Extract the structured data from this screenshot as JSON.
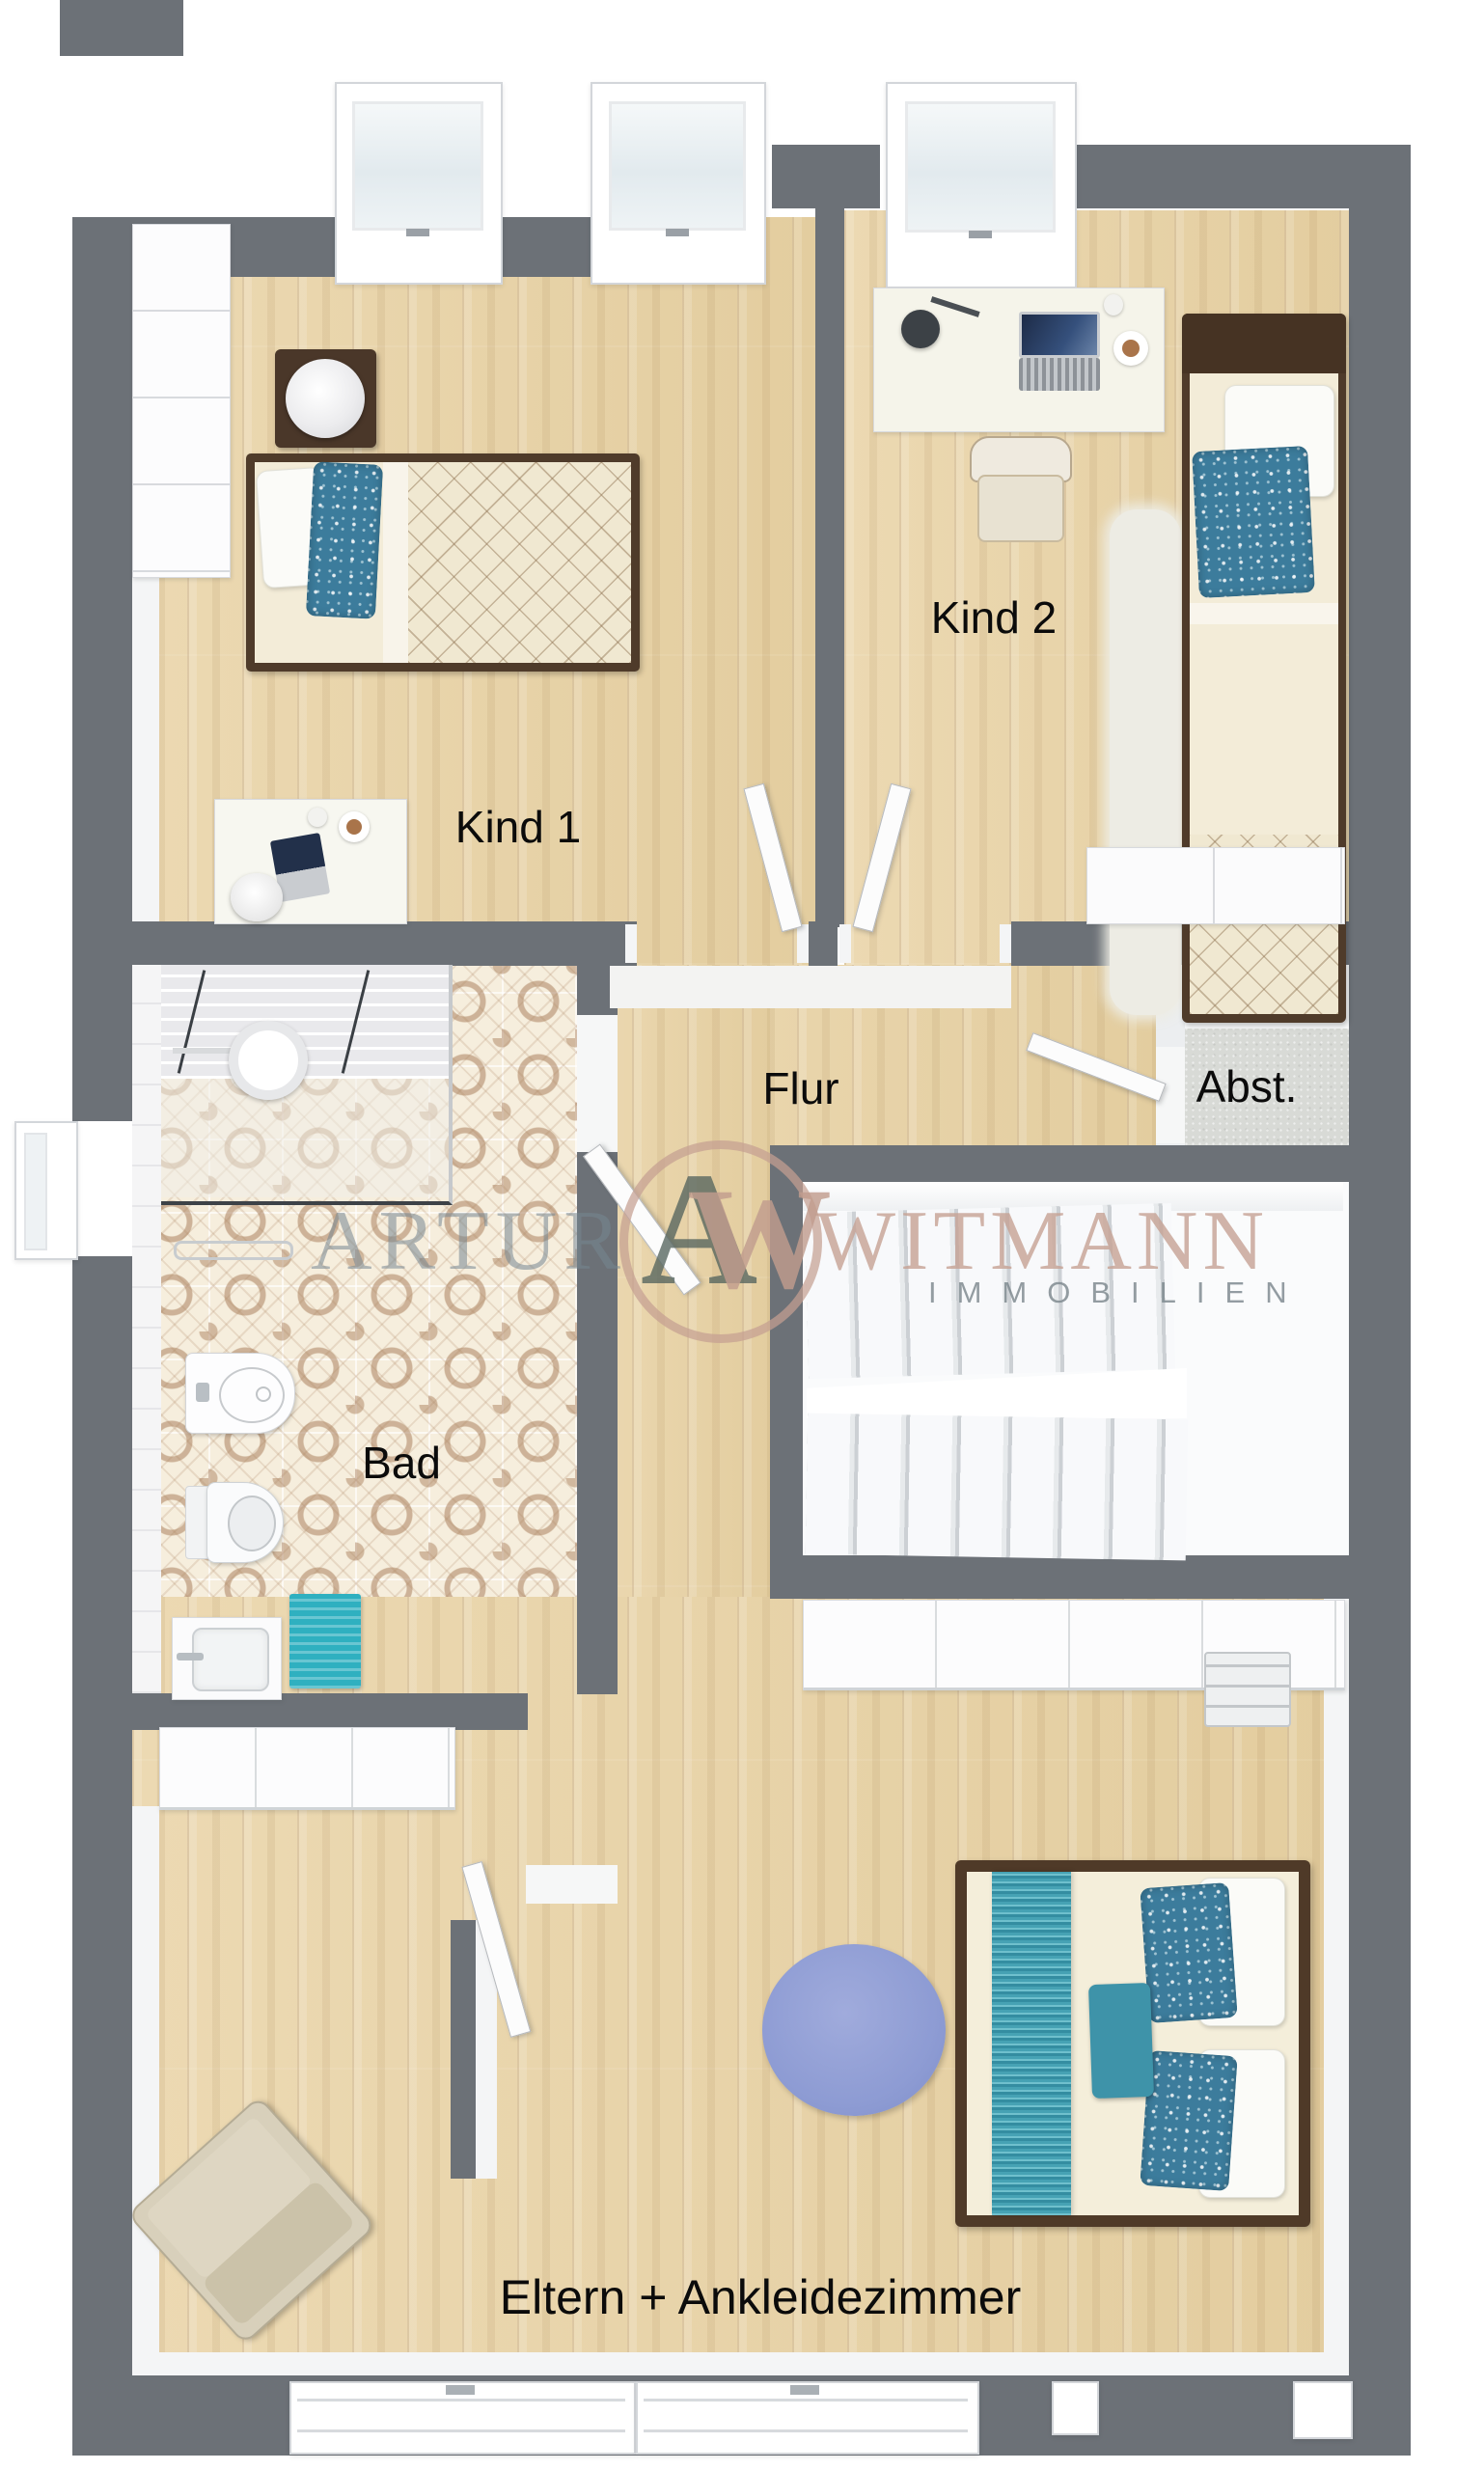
{
  "labels": {
    "kind1": "Kind 1",
    "kind2": "Kind 2",
    "flur": "Flur",
    "abst": "Abst.",
    "bad": "Bad",
    "eltern": "Eltern + Ankleidezimmer"
  },
  "watermark": {
    "name_left": "ARTUR",
    "name_right": "WITMANN",
    "subtitle": "IMMOBILIEN",
    "monogram_a": "A",
    "monogram_w": "W"
  },
  "colors": {
    "wall_gray": "#6c7177",
    "wood_floor": "#e8d4ab",
    "tile_pattern_brown": "#ab8468",
    "accent_teal": "#35aabc",
    "pillow_blue": "#3c7c9c",
    "rug_blue_violet": "#8f9dd2",
    "abst_floor_gray": "#d8dad6",
    "watermark_rose": "#c5a193",
    "watermark_gray": "#78868f",
    "label_text": "#0b0b0b"
  }
}
